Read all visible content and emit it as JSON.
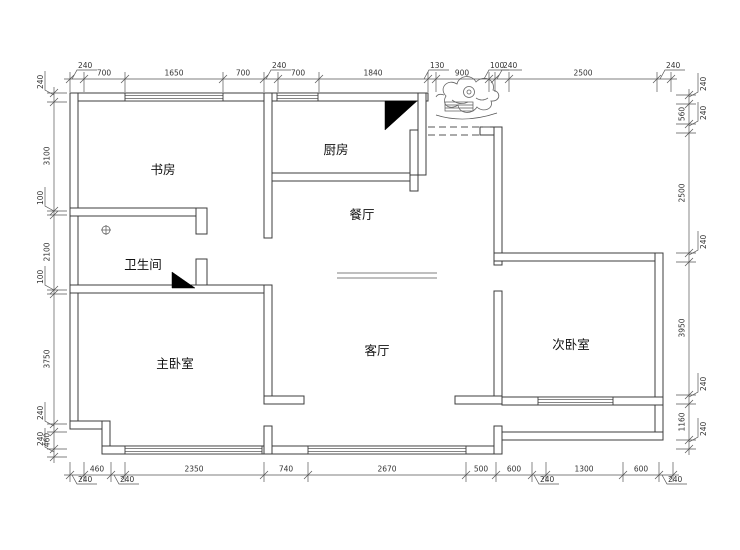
{
  "colors": {
    "wall_line": "#3c3c3c",
    "dim_line": "#555555",
    "dim_text": "#333333",
    "room_text": "#111111",
    "fill_black": "#000000",
    "background": "#ffffff"
  },
  "rooms": [
    {
      "name": "study",
      "label": "书房"
    },
    {
      "name": "kitchen",
      "label": "厨房"
    },
    {
      "name": "dining-room",
      "label": "餐厅"
    },
    {
      "name": "bathroom",
      "label": "卫生间"
    },
    {
      "name": "master-bedroom",
      "label": "主卧室"
    },
    {
      "name": "living-room",
      "label": "客厅"
    },
    {
      "name": "second-bedroom",
      "label": "次卧室"
    }
  ],
  "symbols": [
    {
      "name": "flue-shaft-triangle",
      "location": "kitchen"
    },
    {
      "name": "flue-shaft-triangle",
      "location": "bathroom"
    },
    {
      "name": "floor-drain",
      "location": "bathroom"
    },
    {
      "name": "entry-door-dashed",
      "location": "entrance"
    },
    {
      "name": "doormat",
      "location": "entrance"
    },
    {
      "name": "decorative-sketch",
      "location": "entrance"
    }
  ],
  "dimensions": {
    "top": {
      "orientation": "h",
      "line": 79,
      "ticks": [
        70,
        84,
        125,
        223,
        264,
        278,
        319,
        428,
        436,
        489,
        495,
        509,
        657,
        671
      ],
      "labels": [
        {
          "text": "240",
          "pos": 72,
          "leader": true
        },
        {
          "text": "700",
          "pos": 104
        },
        {
          "text": "1650",
          "pos": 174
        },
        {
          "text": "700",
          "pos": 243
        },
        {
          "text": "240",
          "pos": 266,
          "leader": true
        },
        {
          "text": "700",
          "pos": 298
        },
        {
          "text": "1840",
          "pos": 373
        },
        {
          "text": "130",
          "pos": 424,
          "leader": true
        },
        {
          "text": "900",
          "pos": 462
        },
        {
          "text": "100",
          "pos": 484,
          "leader": true
        },
        {
          "text": "240",
          "pos": 497,
          "leader": true
        },
        {
          "text": "2500",
          "pos": 583
        },
        {
          "text": "240",
          "pos": 660,
          "leader": true
        }
      ]
    },
    "bottom": {
      "orientation": "h",
      "line": 475,
      "ticks": [
        70,
        84,
        111,
        125,
        264,
        308,
        466,
        496,
        532,
        546,
        623,
        659,
        673
      ],
      "labels": [
        {
          "text": "240",
          "pos": 72,
          "leader": true
        },
        {
          "text": "460",
          "pos": 97
        },
        {
          "text": "240",
          "pos": 114,
          "leader": true
        },
        {
          "text": "2350",
          "pos": 194
        },
        {
          "text": "740",
          "pos": 286
        },
        {
          "text": "2670",
          "pos": 387
        },
        {
          "text": "500",
          "pos": 481
        },
        {
          "text": "600",
          "pos": 514
        },
        {
          "text": "240",
          "pos": 534,
          "leader": true
        },
        {
          "text": "1300",
          "pos": 584
        },
        {
          "text": "600",
          "pos": 641
        },
        {
          "text": "240",
          "pos": 662,
          "leader": true
        }
      ]
    },
    "left": {
      "orientation": "v",
      "line": 54,
      "ticks": [
        93,
        102,
        211,
        215,
        290,
        294,
        424,
        432,
        449,
        457
      ],
      "labels": [
        {
          "text": "240",
          "pos": 95,
          "leader": true
        },
        {
          "text": "3100",
          "pos": 156
        },
        {
          "text": "100",
          "pos": 211,
          "leader": true
        },
        {
          "text": "2100",
          "pos": 252
        },
        {
          "text": "100",
          "pos": 290,
          "leader": true
        },
        {
          "text": "3750",
          "pos": 359
        },
        {
          "text": "240",
          "pos": 426,
          "leader": true
        },
        {
          "text": "460",
          "pos": 440
        },
        {
          "text": "240",
          "pos": 452,
          "leader": true
        }
      ]
    },
    "right": {
      "orientation": "v",
      "line": 689,
      "ticks": [
        95,
        104,
        124,
        133,
        253,
        262,
        395,
        404,
        440,
        449
      ],
      "labels": [
        {
          "text": "240",
          "pos": 97,
          "leader": true
        },
        {
          "text": "560",
          "pos": 114
        },
        {
          "text": "240",
          "pos": 126,
          "leader": true
        },
        {
          "text": "2500",
          "pos": 193
        },
        {
          "text": "240",
          "pos": 255,
          "leader": true
        },
        {
          "text": "3950",
          "pos": 328
        },
        {
          "text": "240",
          "pos": 397,
          "leader": true
        },
        {
          "text": "1160",
          "pos": 422
        },
        {
          "text": "240",
          "pos": 442,
          "leader": true
        }
      ]
    }
  }
}
